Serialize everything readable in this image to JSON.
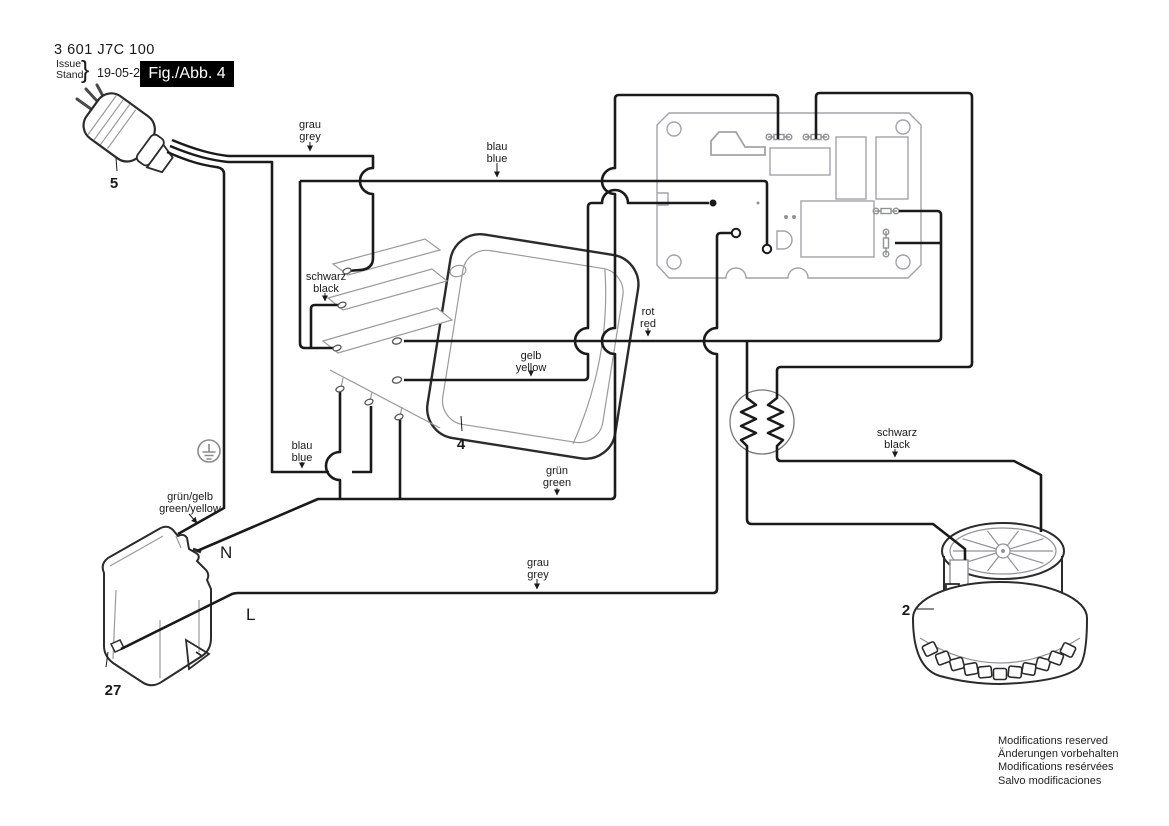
{
  "header": {
    "part_number": "3 601 J7C 100",
    "issue_label": "Issue",
    "stand_label": "Stand",
    "brace": "}",
    "date": "19-05-29",
    "figure_label": "Fig./Abb. 4"
  },
  "components": {
    "plug": {
      "ref": "5"
    },
    "switch": {
      "ref": "4"
    },
    "motor": {
      "ref": "2"
    },
    "connector": {
      "ref": "27"
    }
  },
  "terminals": {
    "neutral": "N",
    "line": "L"
  },
  "wire_labels": {
    "grau_top": {
      "line1": "grau",
      "line2": "grey"
    },
    "blau_top": {
      "line1": "blau",
      "line2": "blue"
    },
    "schwarz_switch": {
      "line1": "schwarz",
      "line2": "black"
    },
    "gelb": {
      "line1": "gelb",
      "line2": "yellow"
    },
    "rot": {
      "line1": "rot",
      "line2": "red"
    },
    "blau_lower": {
      "line1": "blau",
      "line2": "blue"
    },
    "gruen": {
      "line1": "grün",
      "line2": "green"
    },
    "gruen_gelb": {
      "line1": "grün/gelb",
      "line2": "green/yellow"
    },
    "schwarz_motor": {
      "line1": "schwarz",
      "line2": "black"
    },
    "grau_lower": {
      "line1": "grau",
      "line2": "grey"
    }
  },
  "footer": {
    "lines": [
      "Modifications reserved",
      "Änderungen vorbehalten",
      "Modifications resérvées",
      "Salvo modificaciones"
    ]
  },
  "colors": {
    "wire": "#1a1a1a",
    "outline": "#2b2b2b",
    "pcb_gray": "#a2a2aa",
    "detail_gray": "#8f9296",
    "fig_box_bg": "#000000"
  }
}
